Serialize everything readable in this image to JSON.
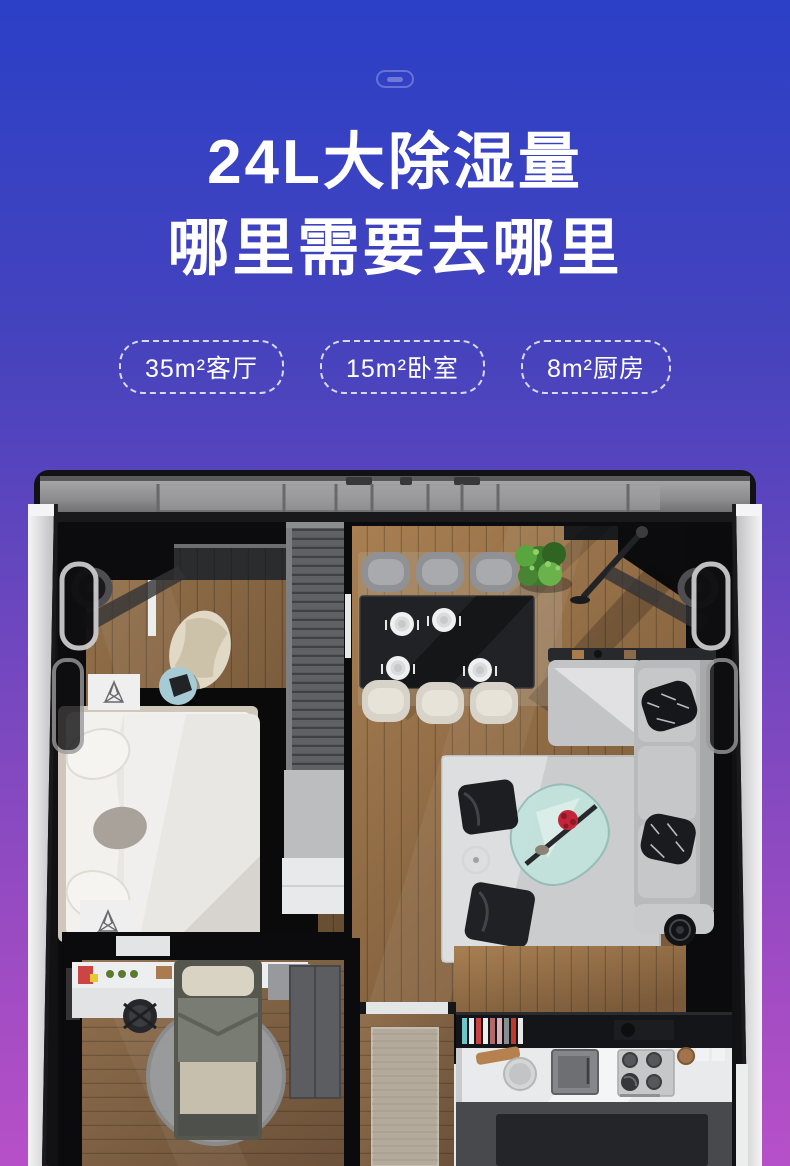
{
  "page": {
    "width": 790,
    "height": 1166,
    "colors": {
      "gradient_top": "#2B40C7",
      "gradient_mid": "#6F47BF",
      "gradient_bottom": "#B750C8",
      "text": "#FFFFFF"
    }
  },
  "header": {
    "title_line1": "24L大除湿量",
    "title_line2": "哪里需要去哪里"
  },
  "badges": [
    {
      "label": "35m²客厅"
    },
    {
      "label": "15m²卧室"
    },
    {
      "label": "8m²厨房"
    }
  ],
  "floor_plan": {
    "alt": "Top-down 3D rendered apartment floor plan: bedroom, dining area, living room, study and kitchen inside an appliance-like frame"
  }
}
